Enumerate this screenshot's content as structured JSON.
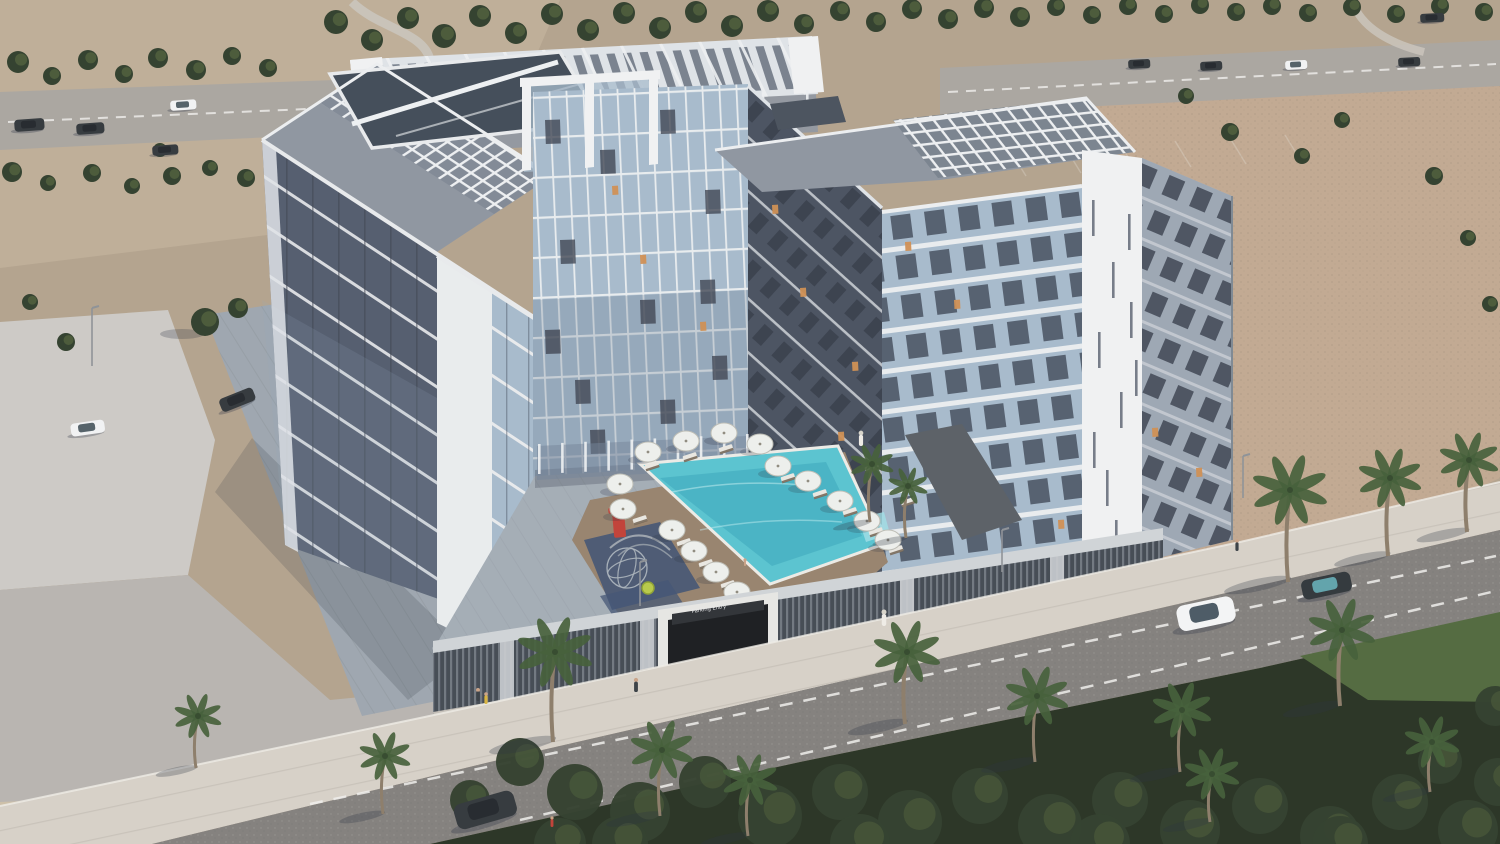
{
  "meta": {
    "type": "architectural-aerial-render",
    "subject": "Aerial rendering of an 8-storey U-shaped residential apartment complex with rooftop pergolas, courtyard swimming pool, palm-lined street and desert surroundings"
  },
  "colors": {
    "sandBase": "#b2a18b",
    "sandLight": "#c6b69e",
    "sandPink": "#c0a78f",
    "sandPale": "#d2c5ad",
    "roadTop": "#a8a49e",
    "roadMain": "#807d7a",
    "roadLine": "#f0efec",
    "sidewalk": "#d6d0c7",
    "plaza": "#ccc9c4",
    "pavement": "#b7b3ae",
    "tileDrive": "#9ba4ad",
    "treeDark": "#2c3a27",
    "treeMid": "#4d5f38",
    "grass": "#4d6639",
    "palm": "#3f5a33",
    "trunk": "#8a7a66",
    "white": "#f1f2f3",
    "whiteDim": "#dfe3e7",
    "roofDeck": "#8c939e",
    "glassBlue": "#a5b9cb",
    "glassDeep": "#6f8095",
    "facadeDark": "#4f586a",
    "facadeDark2": "#454d5c",
    "facadeMid": "#9aa5b2",
    "panelDark": "#39404d",
    "pool": "#55c2cf",
    "poolDeep": "#2e9fb4",
    "deck": "#95806a",
    "podium": "#3f464f",
    "parapet": "#cfd3d6",
    "portal": "#e6e6e3",
    "openingDark": "#15171a",
    "apron": "#6e6a66",
    "playMat": "#3e5070",
    "planter": "#565b61",
    "courtyard": "#a2abb4",
    "foliageBase": "#232e1e",
    "red": "#c03c32",
    "lit": "#cf8c4e",
    "shadow": "#232a3a"
  },
  "scene": {
    "garage_sign": "Parking Entry",
    "trees": [
      [
        18,
        62,
        11
      ],
      [
        52,
        76,
        9
      ],
      [
        88,
        60,
        10
      ],
      [
        124,
        74,
        9
      ],
      [
        158,
        58,
        10
      ],
      [
        196,
        70,
        10
      ],
      [
        232,
        56,
        9
      ],
      [
        268,
        68,
        9
      ],
      [
        12,
        172,
        10
      ],
      [
        48,
        183,
        8
      ],
      [
        92,
        173,
        9
      ],
      [
        132,
        186,
        8
      ],
      [
        172,
        176,
        9
      ],
      [
        210,
        168,
        8
      ],
      [
        246,
        178,
        9
      ],
      [
        278,
        170,
        8
      ],
      [
        336,
        22,
        12
      ],
      [
        372,
        40,
        11
      ],
      [
        408,
        18,
        11
      ],
      [
        444,
        36,
        12
      ],
      [
        480,
        16,
        11
      ],
      [
        516,
        33,
        11
      ],
      [
        552,
        14,
        11
      ],
      [
        588,
        30,
        11
      ],
      [
        624,
        13,
        11
      ],
      [
        660,
        28,
        11
      ],
      [
        696,
        12,
        11
      ],
      [
        732,
        26,
        11
      ],
      [
        768,
        11,
        11
      ],
      [
        804,
        24,
        10
      ],
      [
        840,
        11,
        10
      ],
      [
        876,
        22,
        10
      ],
      [
        912,
        9,
        10
      ],
      [
        948,
        19,
        10
      ],
      [
        984,
        8,
        10
      ],
      [
        1020,
        17,
        10
      ],
      [
        1056,
        7,
        9
      ],
      [
        1092,
        15,
        9
      ],
      [
        1128,
        6,
        9
      ],
      [
        1164,
        14,
        9
      ],
      [
        1200,
        5,
        9
      ],
      [
        1236,
        12,
        9
      ],
      [
        1272,
        6,
        9
      ],
      [
        1308,
        13,
        9
      ],
      [
        1352,
        7,
        9
      ],
      [
        1396,
        14,
        9
      ],
      [
        1440,
        6,
        9
      ],
      [
        1484,
        12,
        9
      ],
      [
        205,
        322,
        14
      ],
      [
        238,
        308,
        10
      ],
      [
        66,
        342,
        9
      ],
      [
        30,
        302,
        8
      ],
      [
        160,
        150,
        7
      ],
      [
        1230,
        132,
        9
      ],
      [
        1302,
        156,
        8
      ],
      [
        1434,
        176,
        9
      ],
      [
        1468,
        238,
        8
      ],
      [
        1490,
        304,
        8
      ],
      [
        1186,
        96,
        8
      ],
      [
        1342,
        120,
        8
      ]
    ],
    "frontFoliage": [
      [
        520,
        762,
        24
      ],
      [
        575,
        792,
        28
      ],
      [
        640,
        812,
        30
      ],
      [
        705,
        782,
        26
      ],
      [
        770,
        816,
        32
      ],
      [
        840,
        792,
        28
      ],
      [
        910,
        822,
        32
      ],
      [
        980,
        796,
        28
      ],
      [
        1050,
        826,
        32
      ],
      [
        1120,
        800,
        28
      ],
      [
        1190,
        830,
        30
      ],
      [
        1260,
        806,
        28
      ],
      [
        1330,
        836,
        30
      ],
      [
        1400,
        802,
        28
      ],
      [
        1468,
        830,
        30
      ],
      [
        1498,
        782,
        24
      ],
      [
        620,
        844,
        28
      ],
      [
        860,
        844,
        30
      ],
      [
        1100,
        844,
        30
      ],
      [
        1340,
        844,
        28
      ],
      [
        470,
        800,
        20
      ],
      [
        1440,
        762,
        22
      ],
      [
        1495,
        706,
        20
      ],
      [
        560,
        844,
        26
      ]
    ],
    "palms": [
      [
        553,
        742,
        90,
        38
      ],
      [
        196,
        768,
        52,
        24
      ],
      [
        383,
        814,
        58,
        26
      ],
      [
        905,
        724,
        72,
        34
      ],
      [
        660,
        816,
        66,
        32
      ],
      [
        748,
        836,
        56,
        28
      ],
      [
        1035,
        762,
        66,
        32
      ],
      [
        1180,
        772,
        62,
        30
      ],
      [
        1340,
        706,
        76,
        34
      ],
      [
        1288,
        582,
        92,
        38
      ],
      [
        1388,
        556,
        78,
        32
      ],
      [
        1467,
        532,
        72,
        30
      ],
      [
        1210,
        822,
        48,
        28
      ],
      [
        1430,
        792,
        50,
        28
      ],
      [
        870,
        522,
        58,
        22
      ],
      [
        906,
        538,
        52,
        20
      ]
    ],
    "umbrellas": [
      [
        648,
        452
      ],
      [
        686,
        441
      ],
      [
        724,
        433
      ],
      [
        760,
        444
      ],
      [
        620,
        484
      ],
      [
        623,
        509
      ],
      [
        672,
        530
      ],
      [
        694,
        551
      ],
      [
        716,
        572
      ],
      [
        737,
        592
      ],
      [
        758,
        612
      ],
      [
        778,
        466
      ],
      [
        808,
        481
      ],
      [
        840,
        501
      ],
      [
        867,
        521
      ],
      [
        888,
        540
      ]
    ],
    "loungers": [
      [
        652,
        466
      ],
      [
        690,
        457
      ],
      [
        726,
        449
      ],
      [
        640,
        520
      ],
      [
        684,
        543
      ],
      [
        706,
        564
      ],
      [
        728,
        585
      ],
      [
        750,
        604
      ],
      [
        788,
        478
      ],
      [
        820,
        494
      ],
      [
        850,
        512
      ],
      [
        876,
        532
      ],
      [
        896,
        550
      ],
      [
        908,
        502
      ],
      [
        872,
        468
      ],
      [
        758,
        628
      ]
    ],
    "cars": [
      [
        14,
        120,
        30,
        12,
        -4,
        "dark"
      ],
      [
        76,
        124,
        28,
        11,
        -4,
        "dark"
      ],
      [
        170,
        101,
        26,
        10,
        -4,
        "white"
      ],
      [
        152,
        146,
        26,
        10,
        -4,
        "dark"
      ],
      [
        1128,
        60,
        22,
        9,
        -3,
        "dark"
      ],
      [
        1200,
        62,
        22,
        9,
        -3,
        "dark"
      ],
      [
        1285,
        61,
        22,
        9,
        -3,
        "white"
      ],
      [
        1398,
        58,
        22,
        9,
        -3,
        "dark"
      ],
      [
        1420,
        14,
        24,
        9,
        -3,
        "dark"
      ],
      [
        70,
        424,
        34,
        13,
        -8,
        "white"
      ],
      [
        218,
        400,
        36,
        14,
        -22,
        "dark"
      ],
      [
        1175,
        607,
        58,
        26,
        -12,
        "suv"
      ],
      [
        1300,
        581,
        50,
        20,
        -12,
        "darkteal"
      ],
      [
        452,
        806,
        62,
        26,
        -16,
        "dark"
      ]
    ],
    "people": [
      [
        861,
        446,
        13,
        "robe"
      ],
      [
        884,
        626,
        14,
        "robe"
      ],
      [
        636,
        692,
        12,
        "dark"
      ],
      [
        478,
        701,
        11,
        "dark"
      ],
      [
        486,
        704,
        10,
        "vest"
      ],
      [
        1237,
        551,
        10,
        "dark"
      ],
      [
        552,
        827,
        9,
        "red"
      ],
      [
        745,
        566,
        6,
        "swim"
      ]
    ],
    "litWindows": [
      [
        640,
        255
      ],
      [
        700,
        322
      ],
      [
        612,
        186
      ],
      [
        800,
        288
      ],
      [
        852,
        362
      ],
      [
        772,
        205
      ],
      [
        838,
        432
      ],
      [
        1058,
        520
      ],
      [
        1152,
        428
      ],
      [
        1196,
        468
      ],
      [
        905,
        242
      ],
      [
        954,
        300
      ]
    ],
    "towerPanels": [
      [
        545,
        120
      ],
      [
        600,
        150
      ],
      [
        660,
        110
      ],
      [
        705,
        190
      ],
      [
        560,
        240
      ],
      [
        640,
        300
      ],
      [
        700,
        280
      ],
      [
        575,
        380
      ],
      [
        660,
        400
      ],
      [
        712,
        356
      ],
      [
        590,
        430
      ],
      [
        545,
        330
      ]
    ],
    "pierSlits": [
      [
        1092,
        200
      ],
      [
        1112,
        262
      ],
      [
        1128,
        214
      ],
      [
        1098,
        332
      ],
      [
        1120,
        392
      ],
      [
        1106,
        470
      ],
      [
        1130,
        302
      ],
      [
        1093,
        432
      ],
      [
        1115,
        520
      ],
      [
        1135,
        360
      ]
    ],
    "colonnades": [
      {
        "target": "g-posts-band",
        "x1": 364,
        "y1": 112,
        "x2": 806,
        "y2": 90,
        "h": 22,
        "n": 11
      },
      {
        "target": "g-posts-court",
        "x1": 538,
        "y1": 444,
        "x2": 746,
        "y2": 434,
        "h": 30,
        "n": 10
      }
    ],
    "lightPoles": [
      [
        92,
        366,
        58
      ],
      [
        640,
        606,
        44
      ],
      [
        1002,
        572,
        42
      ],
      [
        1243,
        498,
        42
      ]
    ],
    "parkingLines": [
      [
        1010,
        150
      ],
      [
        1065,
        147
      ],
      [
        1120,
        144
      ],
      [
        1175,
        141
      ],
      [
        1230,
        138
      ],
      [
        1285,
        135
      ]
    ]
  }
}
